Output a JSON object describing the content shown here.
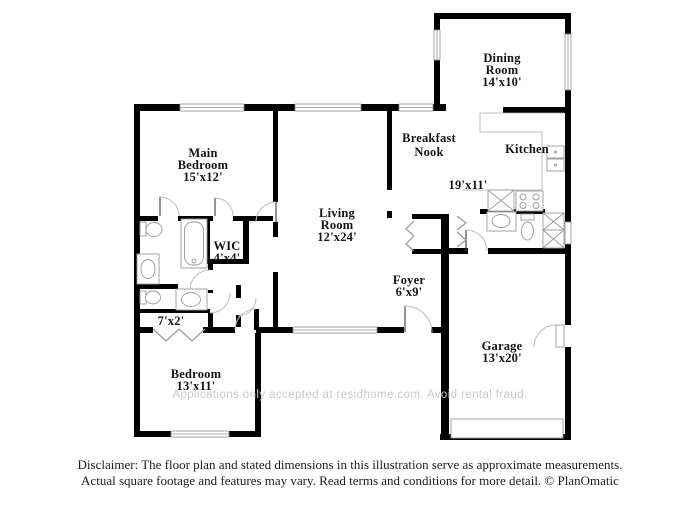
{
  "plan": {
    "colors": {
      "background": "#ffffff",
      "walls": "#000000",
      "fixtures": "#9a9a9a",
      "labels": "#141414",
      "watermark": "#c9c9c9",
      "disclaimer": "#1c1c1c"
    },
    "rooms": [
      {
        "id": "dining-room",
        "x": 502,
        "lines": [
          "Dining",
          "Room",
          "14'x10'"
        ],
        "line_y": [
          62,
          74,
          86
        ]
      },
      {
        "id": "breakfast-nook",
        "x": 429,
        "lines": [
          "Breakfast",
          "Nook"
        ],
        "line_y": [
          142,
          156
        ]
      },
      {
        "id": "kitchen",
        "x": 527,
        "lines": [
          "Kitchen"
        ],
        "line_y": [
          153
        ]
      },
      {
        "id": "kitchen-dims",
        "x": 468,
        "lines": [
          "19'x11'"
        ],
        "line_y": [
          189
        ]
      },
      {
        "id": "main-bedroom",
        "x": 203,
        "lines": [
          "Main",
          "Bedroom",
          "15'x12'"
        ],
        "line_y": [
          157,
          169,
          181
        ]
      },
      {
        "id": "living-room",
        "x": 337,
        "lines": [
          "Living",
          "Room",
          "12'x24'"
        ],
        "line_y": [
          217,
          229,
          241
        ]
      },
      {
        "id": "wic",
        "x": 227,
        "lines": [
          "WIC",
          "4'x4'"
        ],
        "line_y": [
          250,
          262
        ]
      },
      {
        "id": "foyer",
        "x": 409,
        "lines": [
          "Foyer",
          "6'x9'"
        ],
        "line_y": [
          284,
          296
        ]
      },
      {
        "id": "hall-closet",
        "x": 171,
        "lines": [
          "7'x2'"
        ],
        "line_y": [
          325
        ]
      },
      {
        "id": "bedroom",
        "x": 196,
        "lines": [
          "Bedroom",
          "13'x11'"
        ],
        "line_y": [
          378,
          390
        ]
      },
      {
        "id": "garage",
        "x": 502,
        "lines": [
          "Garage",
          "13'x20'"
        ],
        "line_y": [
          350,
          362
        ]
      }
    ],
    "watermark": "Applications only accepted at residhome.com. Avoid rental fraud.",
    "disclaimer_line1": "Disclaimer: The floor plan and stated dimensions in this illustration serve as approximate measurements.",
    "disclaimer_line2": "Actual square footage and features may vary. Read terms and conditions for more detail. © PlanOmatic"
  }
}
